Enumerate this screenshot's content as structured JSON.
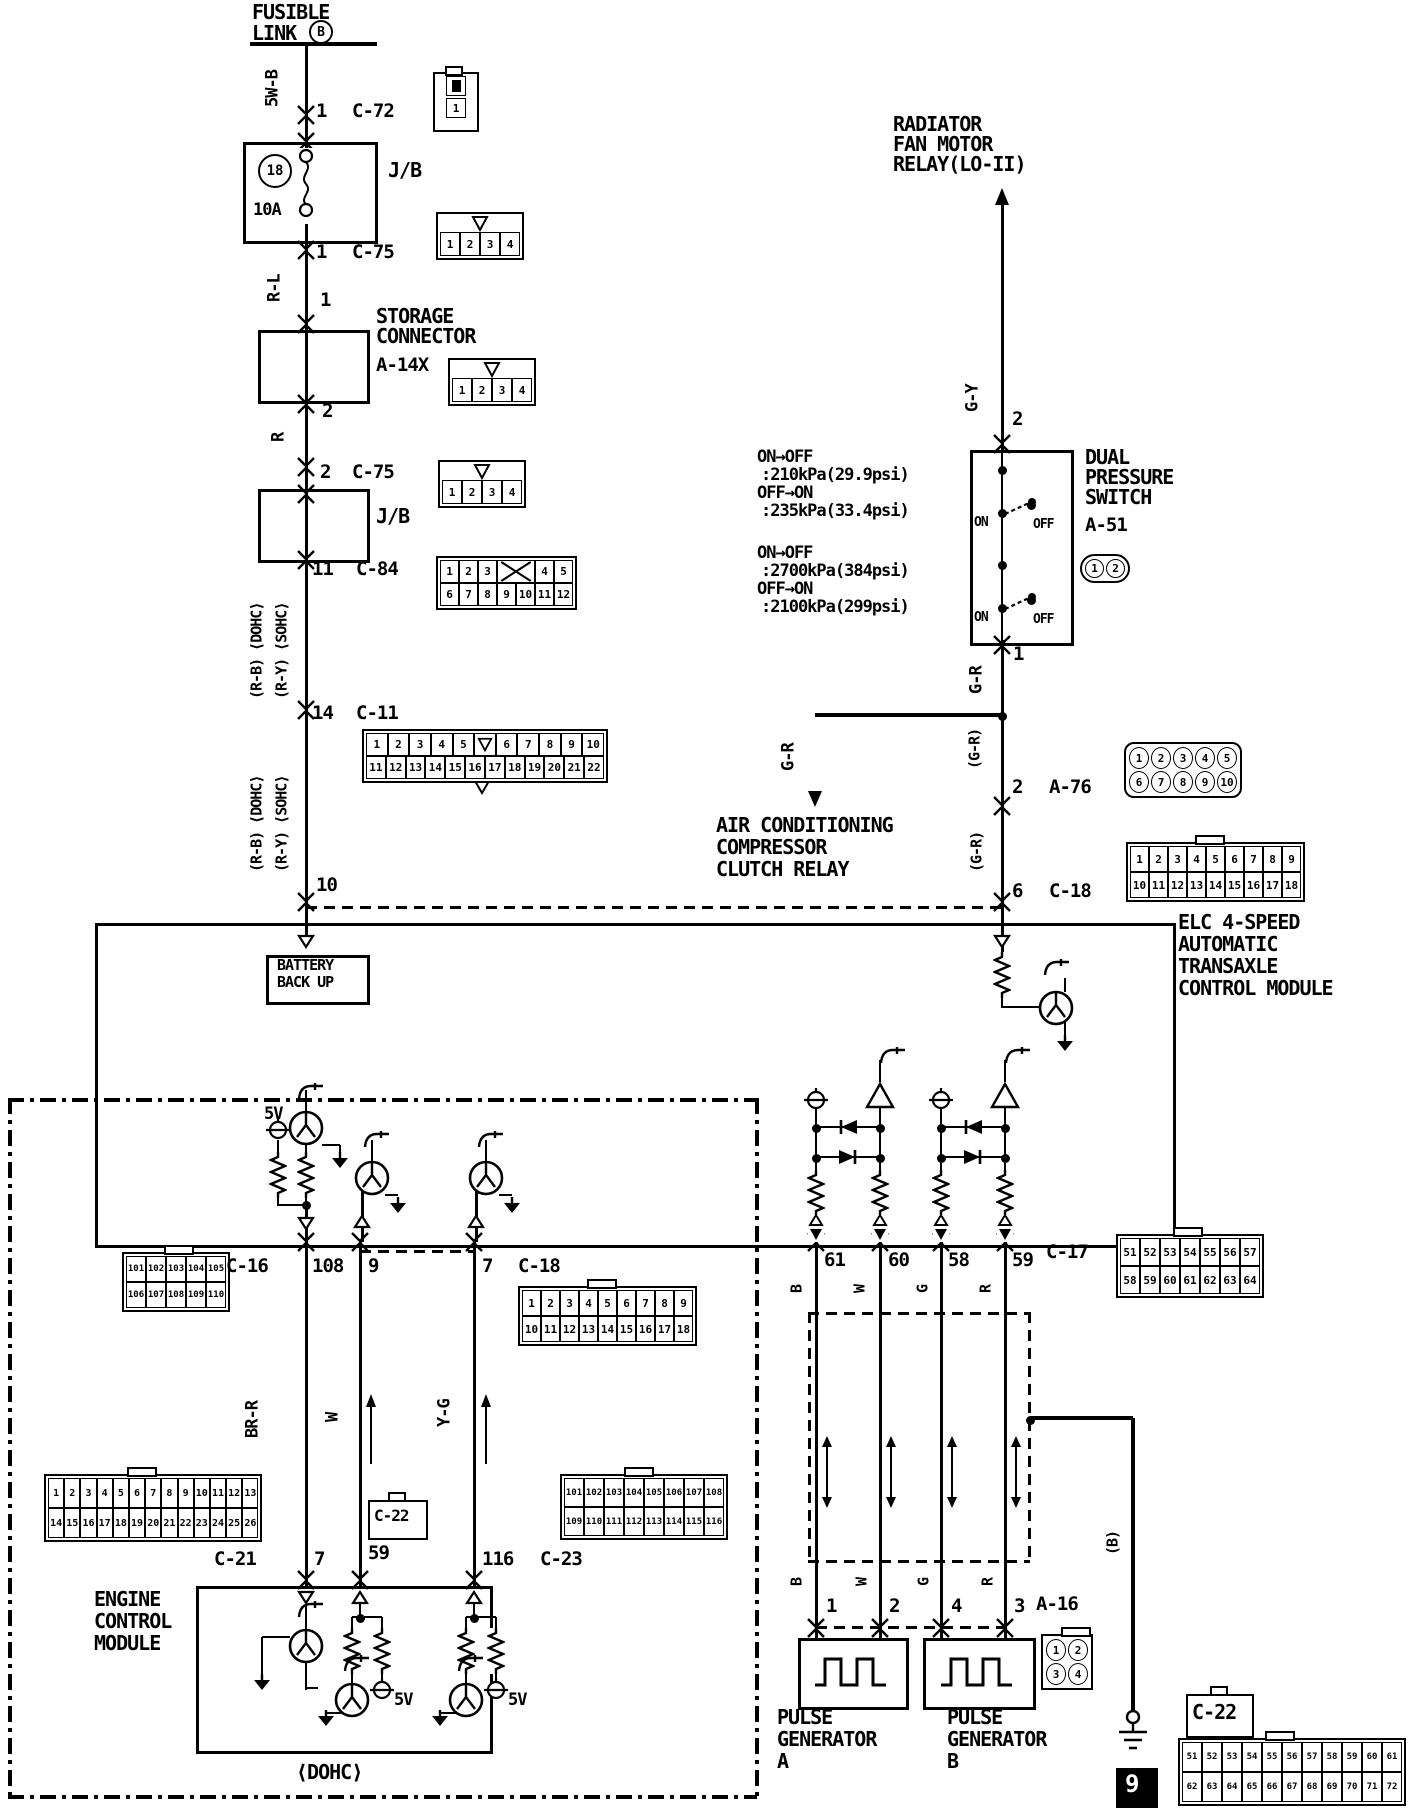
{
  "diagram": {
    "colors": {
      "ink": "#000000",
      "paper": "#ffffff"
    },
    "labels": {
      "f1": "FUSIBLE",
      "f2": "LINK",
      "f3": "B",
      "p1": "1",
      "c72": "C-72",
      "jb1": "J/B",
      "fuse18": "18",
      "fuseA": "10A",
      "p2": "1",
      "c75a": "C-75",
      "rl": "R-L",
      "p3": "1",
      "st1": "STORAGE",
      "st2": "CONNECTOR",
      "st3": "A-14X",
      "p4": "2",
      "r": "R",
      "p5": "2",
      "c75b": "C-75",
      "jb2": "J/B",
      "p6": "11",
      "c84": "C-84",
      "rb1": "(R-B) ⟨DOHC⟩",
      "ry1": "(R-Y) ⟨SOHC⟩",
      "p7": "14",
      "c11": "C-11",
      "rb2": "(R-B) ⟨DOHC⟩",
      "ry2": "(R-Y) ⟨SOHC⟩",
      "p8": "10",
      "rad1": "RADIATOR",
      "rad2": "FAN MOTOR",
      "rad3": "RELAY(LO-II)",
      "gy": "G-Y",
      "p9": "2",
      "pr1": "ON→OFF",
      "pr2": ":210kPa(29.9psi)",
      "pr3": "OFF→ON",
      "pr4": ":235kPa(33.4psi)",
      "pr5": "ON→OFF",
      "pr6": ":2700kPa(384psi)",
      "pr7": "OFF→ON",
      "pr8": ":2100kPa(299psi)",
      "on1": "ON",
      "off1": "OFF",
      "on2": "ON",
      "off2": "OFF",
      "dp1": "DUAL",
      "dp2": "PRESSURE",
      "dp3": "SWITCH",
      "dp4": "A-51",
      "p10": "1",
      "gr1": "G-R",
      "gr2": "G-R",
      "ac1": "AIR CONDITIONING",
      "ac2": "COMPRESSOR",
      "ac3": "CLUTCH RELAY",
      "grp1": "(G-R)",
      "p11": "2",
      "a76": "A-76",
      "grp2": "(G-R)",
      "p12": "6",
      "c18a": "C-18",
      "elc1": "ELC 4-SPEED",
      "elc2": "AUTOMATIC",
      "elc3": "TRANSAXLE",
      "elc4": "CONTROL MODULE",
      "bb1": "BATTERY",
      "bb2": "BACK UP",
      "v5": "5V",
      "c16": "C-16",
      "p108": "108",
      "p9b": "9",
      "p7b": "7",
      "c18b": "C-18",
      "p61": "61",
      "p60": "60",
      "p58": "58",
      "p59": "59",
      "c17": "C-17",
      "b1": "B",
      "w1": "W",
      "g1": "G",
      "r1": "R",
      "brr": "BR-R",
      "wl": "W",
      "yg": "Y-G",
      "c21": "C-21",
      "p7e": "7",
      "p59e": "59",
      "c22s": "C-22",
      "p116": "116",
      "c23": "C-23",
      "ecm1": "ENGINE",
      "ecm2": "CONTROL",
      "ecm3": "MODULE",
      "v5a": "5V",
      "v5b": "5V",
      "dohc": "⟨DOHC⟩",
      "b2": "B",
      "w2": "W",
      "g2": "G",
      "r2": "R",
      "pg1": "1",
      "pg2": "2",
      "pg4": "4",
      "pg3": "3",
      "a16": "A-16",
      "pga1": "PULSE",
      "pga2": "GENERATOR",
      "pga3": "A",
      "pgb1": "PULSE",
      "pgb2": "GENERATOR",
      "pgb3": "B",
      "bsh": "(B)",
      "pagenum": "9",
      "c22br": "C-22"
    },
    "connectors": {
      "c72": {
        "rows": [
          [
            "1"
          ]
        ]
      },
      "c75a": {
        "rows": [
          [
            "1",
            "2",
            "3",
            "4"
          ]
        ]
      },
      "a14x": {
        "rows": [
          [
            "1",
            "2",
            "3",
            "4"
          ]
        ]
      },
      "c75b": {
        "rows": [
          [
            "1",
            "2",
            "3",
            "4"
          ]
        ]
      },
      "c84": {
        "rows": [
          [
            "1",
            "2",
            "3",
            "X",
            "4",
            "5"
          ],
          [
            "6",
            "7",
            "8",
            "9",
            "10",
            "11",
            "12"
          ]
        ]
      },
      "c11": {
        "rows": [
          [
            "1",
            "2",
            "3",
            "4",
            "5",
            "V",
            "6",
            "7",
            "8",
            "9",
            "10"
          ],
          [
            "11",
            "12",
            "13",
            "14",
            "15",
            "16",
            "17",
            "18",
            "19",
            "20",
            "21",
            "22"
          ]
        ]
      },
      "a51": {
        "rows": [
          [
            "1",
            "2"
          ]
        ]
      },
      "a76": {
        "rows": [
          [
            "1",
            "2",
            "3",
            "4",
            "5"
          ],
          [
            "6",
            "7",
            "8",
            "9",
            "10"
          ]
        ]
      },
      "c18a": {
        "rows": [
          [
            "1",
            "2",
            "3",
            "4",
            "5",
            "6",
            "7",
            "8",
            "9"
          ],
          [
            "10",
            "11",
            "12",
            "13",
            "14",
            "15",
            "16",
            "17",
            "18"
          ]
        ]
      },
      "c16": {
        "rows": [
          [
            "101",
            "102",
            "103",
            "104",
            "105"
          ],
          [
            "106",
            "107",
            "108",
            "109",
            "110"
          ]
        ]
      },
      "c18b": {
        "rows": [
          [
            "1",
            "2",
            "3",
            "4",
            "5",
            "6",
            "7",
            "8",
            "9"
          ],
          [
            "10",
            "11",
            "12",
            "13",
            "14",
            "15",
            "16",
            "17",
            "18"
          ]
        ]
      },
      "c17": {
        "rows": [
          [
            "51",
            "52",
            "53",
            "54",
            "55",
            "56",
            "57"
          ],
          [
            "58",
            "59",
            "60",
            "61",
            "62",
            "63",
            "64"
          ]
        ]
      },
      "c21": {
        "rows": [
          [
            "1",
            "2",
            "3",
            "4",
            "5",
            "6",
            "7",
            "8",
            "9",
            "10",
            "11",
            "12",
            "13"
          ],
          [
            "14",
            "15",
            "16",
            "17",
            "18",
            "19",
            "20",
            "21",
            "22",
            "23",
            "24",
            "25",
            "26"
          ]
        ]
      },
      "c23": {
        "rows": [
          [
            "101",
            "102",
            "103",
            "104",
            "105",
            "106",
            "107",
            "108"
          ],
          [
            "109",
            "110",
            "111",
            "112",
            "113",
            "114",
            "115",
            "116"
          ]
        ]
      },
      "a16": {
        "rows": [
          [
            "1",
            "2"
          ],
          [
            "3",
            "4"
          ]
        ]
      },
      "c22": {
        "rows": [
          [
            "51",
            "52",
            "53",
            "54",
            "55",
            "56",
            "57",
            "58",
            "59",
            "60",
            "61"
          ],
          [
            "62",
            "63",
            "64",
            "65",
            "66",
            "67",
            "68",
            "69",
            "70",
            "71",
            "72"
          ]
        ]
      }
    },
    "icons": {
      "connector-mate-icon": "double chevron at connector crossing",
      "fuse-icon": "coil between two circles",
      "ground-icon": "filled triangle arrow",
      "earth-ground-icon": "circle over three bars",
      "resistor-icon": "zigzag",
      "transistor-icon": "circle with V",
      "diode-icon": "filled triangle with bar",
      "voltage-source-icon": "circle with cross line",
      "buffer-icon": "open triangle with hook",
      "square-wave-icon": "pulse waveform",
      "keying-notch-icon": "open triangle notch",
      "junction-dot-icon": "filled dot",
      "signal-arrow-icon": "single-headed arrow",
      "double-arrow-icon": "double-headed arrow",
      "switch-contact-icon": "dot with dashed arm"
    }
  }
}
